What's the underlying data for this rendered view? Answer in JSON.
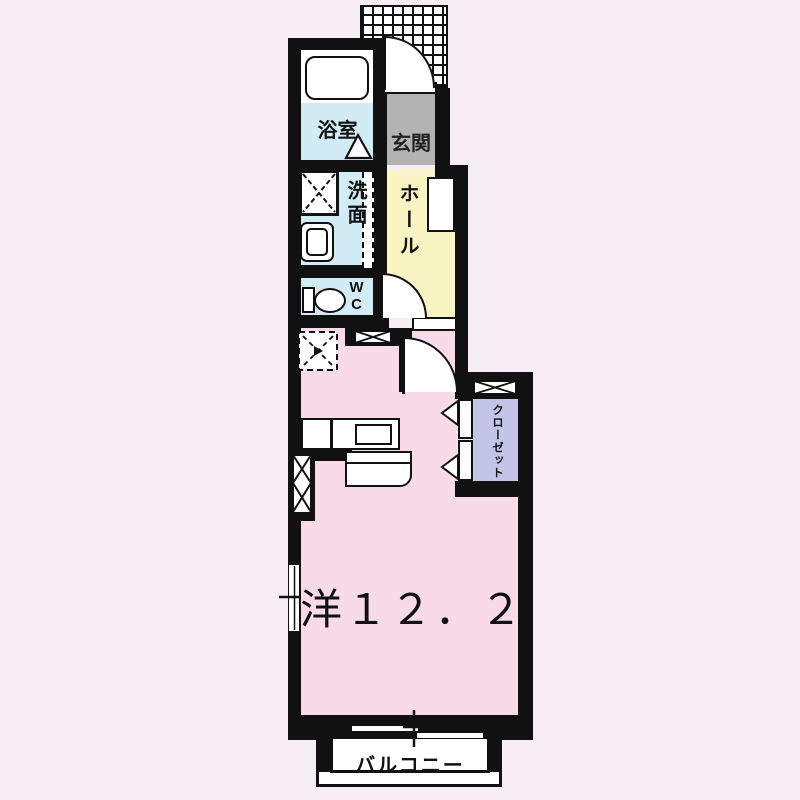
{
  "floorplan": {
    "rooms": {
      "bathroom": {
        "label": "浴室",
        "floor_color": "#d2ecf5"
      },
      "entrance": {
        "label": "玄関",
        "floor_color": "#b3b3b3"
      },
      "washroom": {
        "label": "洗面",
        "floor_color": "#d2ecf5"
      },
      "hall": {
        "label": "ホール",
        "floor_color": "#f9f5c2"
      },
      "toilet": {
        "label": "WC",
        "floor_color": "#d2ecf5"
      },
      "closet": {
        "label": "クローゼット",
        "floor_color": "#c4c4e8"
      },
      "living": {
        "label": "洋１２．２",
        "floor_color": "#f8dbe7"
      },
      "balcony": {
        "label": "バルコニー",
        "floor_color": "#ffffff"
      }
    },
    "colors": {
      "background": "#f7eef3",
      "wall": "#111111",
      "water_rooms": "#d2ecf5",
      "hall": "#f9f5c2",
      "entrance": "#b3b3b3",
      "closet": "#c4c4e8",
      "living": "#f8dbe7"
    }
  }
}
